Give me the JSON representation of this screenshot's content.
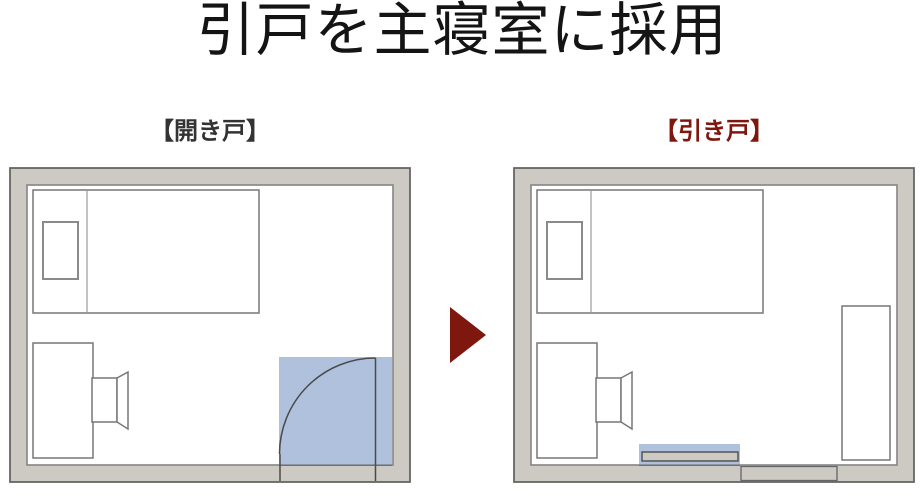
{
  "title": "引戸を主寝室に採用",
  "panels": {
    "left": {
      "label": "【開き戸】"
    },
    "right": {
      "label": "【引き戸】"
    }
  },
  "colors": {
    "background": "#FFFFFF",
    "title-text": "#141414",
    "label-left": "#333333",
    "accent-red": "#7E180F",
    "wall-fill": "#CDC9C3",
    "wall-outline": "#5E5E5E",
    "inner-line": "#8A8A8A",
    "furniture-line": "#777777",
    "highlight-blue": "#A9BCDB"
  }
}
